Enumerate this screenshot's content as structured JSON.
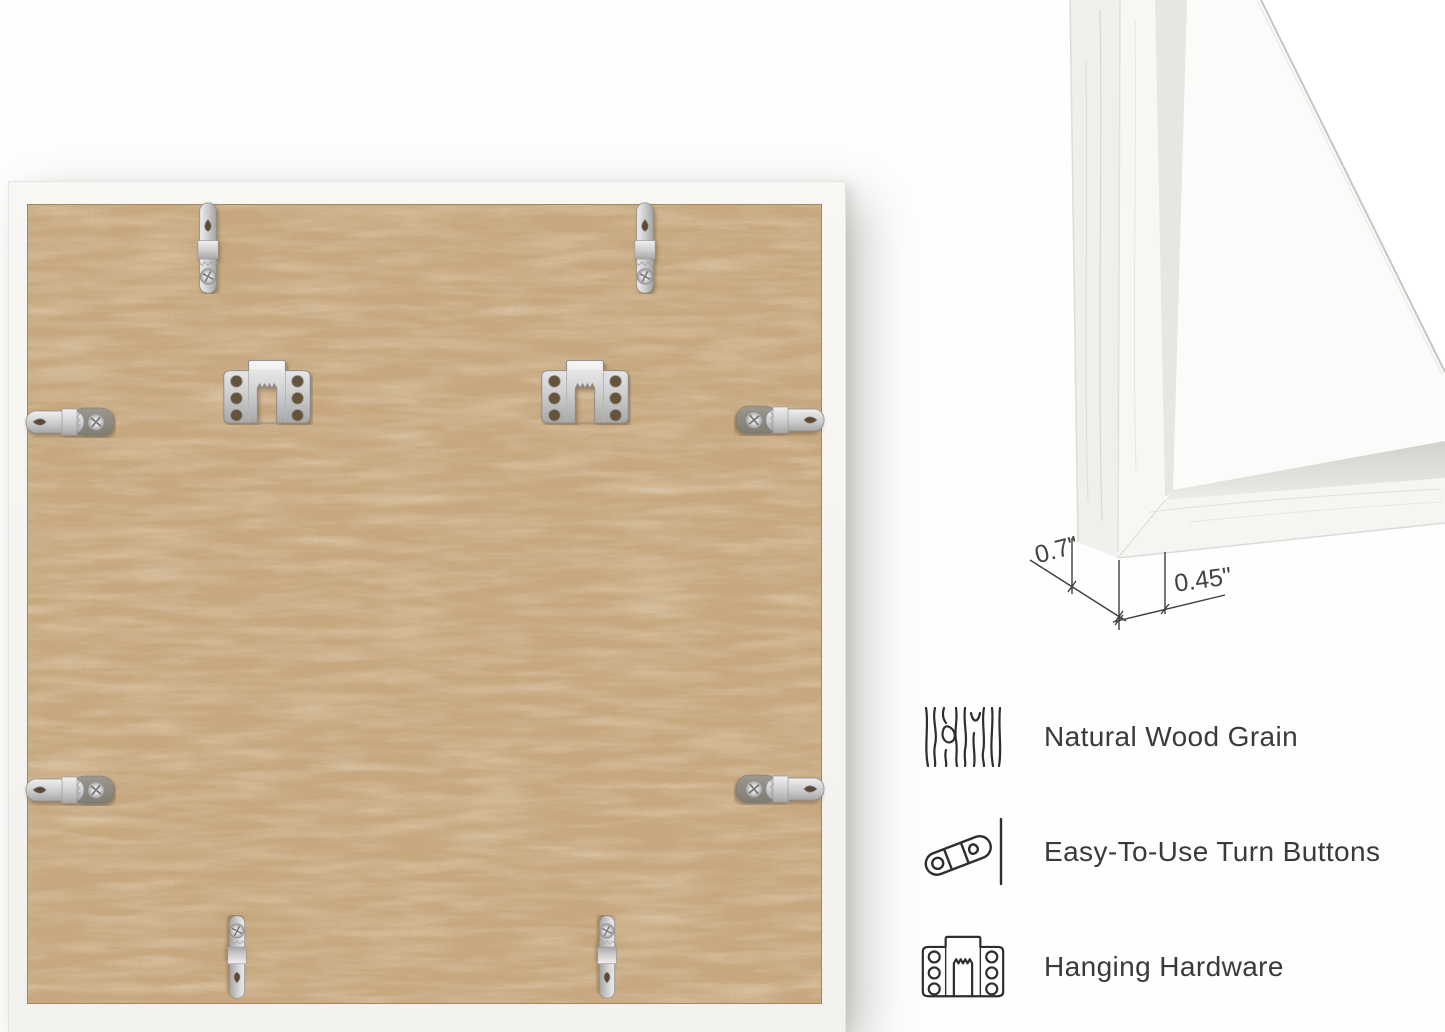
{
  "corner_detail": {
    "depth_dimension_label": "0.7\"",
    "face_width_dimension_label": "0.45\""
  },
  "features": {
    "items": [
      {
        "icon": "wood-grain-icon",
        "label": "Natural Wood Grain"
      },
      {
        "icon": "turn-button-icon",
        "label": "Easy-To-Use Turn Buttons"
      },
      {
        "icon": "hanging-hardware-icon",
        "label": "Hanging Hardware"
      }
    ]
  },
  "colors": {
    "mdf_backing": "#c7a87f",
    "frame_white": "#f6f5f2",
    "annotation_line": "#3d3d3d",
    "annotation_text": "#424242",
    "feature_text": "#3a3a3a",
    "icon_stroke": "#2e2e2e",
    "hardware_metal": "#c9c9c9"
  }
}
